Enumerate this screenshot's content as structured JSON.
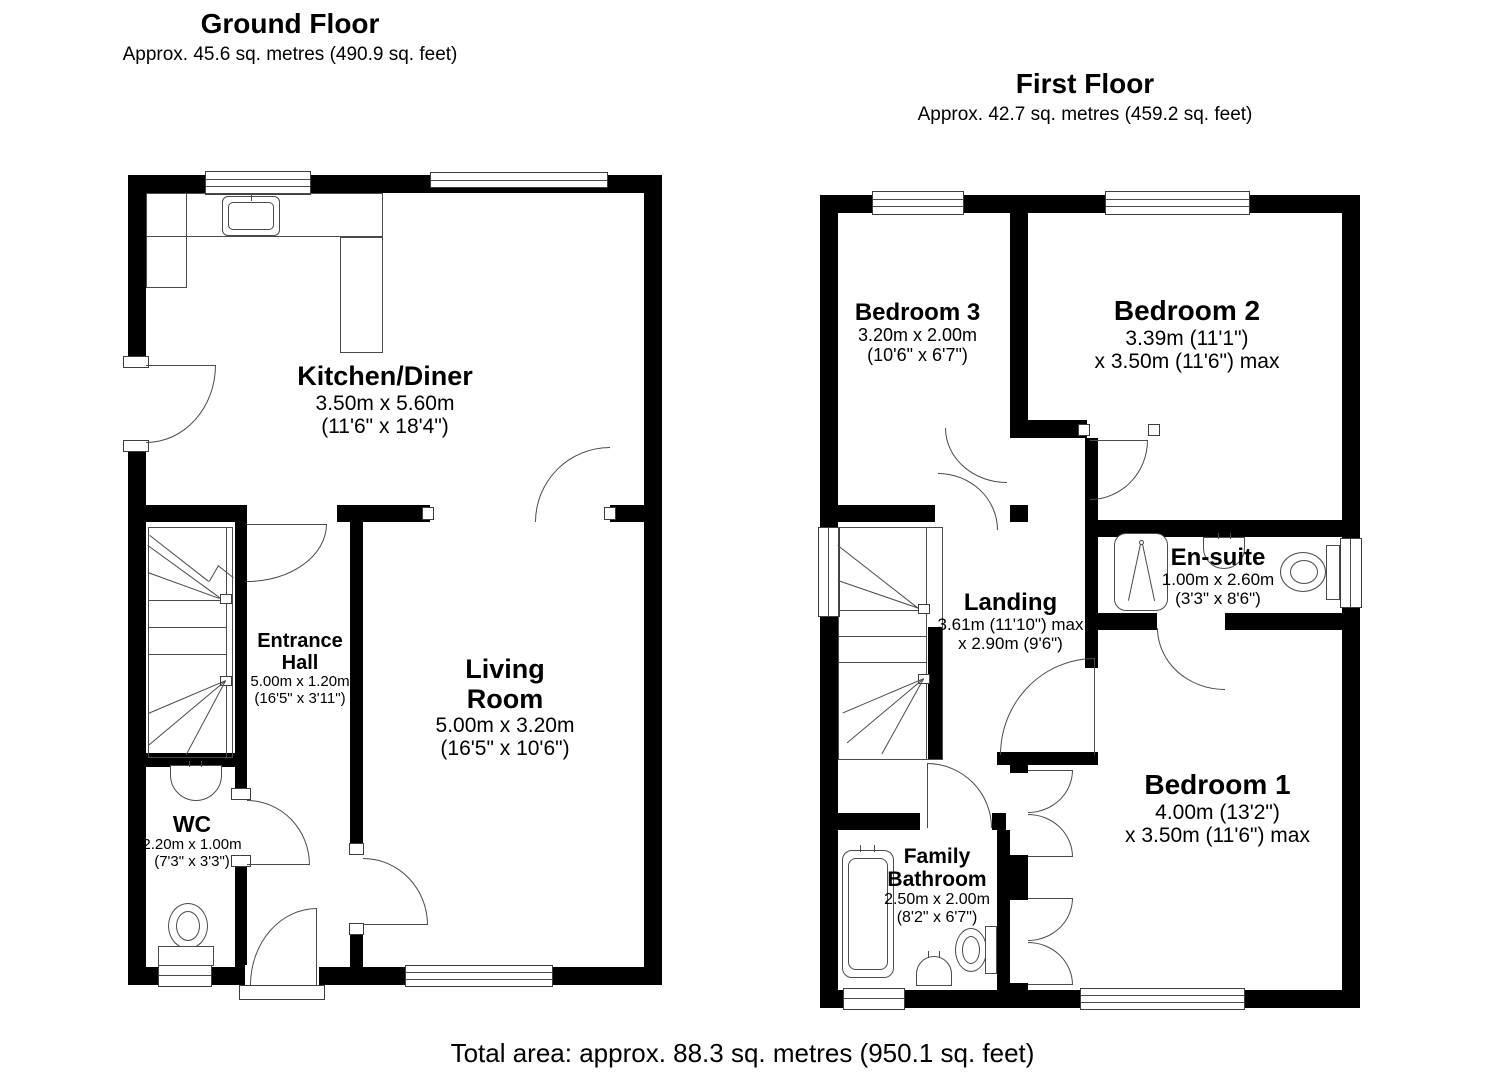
{
  "palette": {
    "wall_color": "#000000",
    "line_color": "#4a4a4a",
    "background": "#ffffff"
  },
  "ground_floor": {
    "title": "Ground Floor",
    "subtitle": "Approx. 45.6 sq. metres (490.9 sq. feet)",
    "rooms": {
      "kitchen": {
        "name": "Kitchen/Diner",
        "dim_metric": "3.50m x 5.60m",
        "dim_imperial": "(11'6\" x 18'4\")"
      },
      "hall": {
        "name_line1": "Entrance",
        "name_line2": "Hall",
        "dim_metric": "5.00m x 1.20m",
        "dim_imperial": "(16'5\" x 3'11\")"
      },
      "living": {
        "name_line1": "Living",
        "name_line2": "Room",
        "dim_metric": "5.00m x 3.20m",
        "dim_imperial": "(16'5\" x 10'6\")"
      },
      "wc": {
        "name": "WC",
        "dim_metric": "2.20m x 1.00m",
        "dim_imperial": "(7'3\" x 3'3\")"
      }
    }
  },
  "first_floor": {
    "title": "First Floor",
    "subtitle": "Approx. 42.7 sq. metres (459.2 sq. feet)",
    "rooms": {
      "bedroom3": {
        "name": "Bedroom 3",
        "dim_metric": "3.20m x 2.00m",
        "dim_imperial": "(10'6\" x 6'7\")"
      },
      "bedroom2": {
        "name": "Bedroom 2",
        "dim_line1": "3.39m (11'1\")",
        "dim_line2": "x 3.50m (11'6\") max"
      },
      "ensuite": {
        "name": "En-suite",
        "dim_metric": "1.00m x 2.60m",
        "dim_imperial": "(3'3\" x 8'6\")"
      },
      "landing": {
        "name": "Landing",
        "dim_line1": "3.61m (11'10\") max",
        "dim_line2": "x 2.90m (9'6\")"
      },
      "bedroom1": {
        "name": "Bedroom 1",
        "dim_line1": "4.00m (13'2\")",
        "dim_line2": "x 3.50m (11'6\") max"
      },
      "bathroom": {
        "name_line1": "Family",
        "name_line2": "Bathroom",
        "dim_metric": "2.50m x 2.00m",
        "dim_imperial": "(8'2\" x 6'7\")"
      }
    }
  },
  "footer": {
    "total_area": "Total area: approx. 88.3 sq. metres (950.1 sq. feet)"
  }
}
